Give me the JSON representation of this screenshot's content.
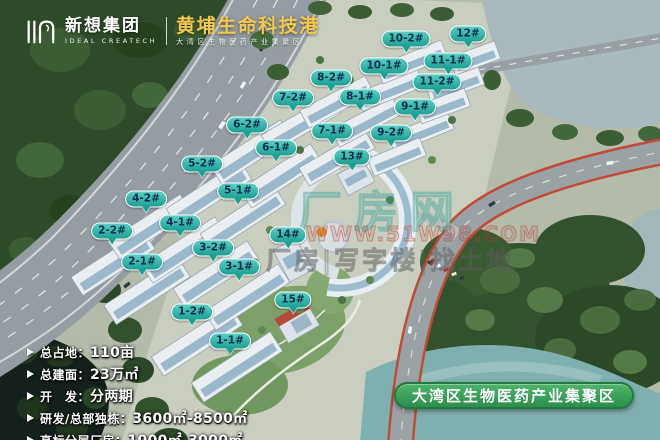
{
  "header": {
    "company_cn": "新想集团",
    "company_en": "IDEAL CREATECH",
    "title": "黄埔生命科技港",
    "subtitle": "大湾区生物医药产业集聚区"
  },
  "building_labels": [
    {
      "text": "1-1#",
      "x": 230,
      "y": 341
    },
    {
      "text": "1-2#",
      "x": 192,
      "y": 312
    },
    {
      "text": "2-1#",
      "x": 142,
      "y": 262
    },
    {
      "text": "2-2#",
      "x": 112,
      "y": 231
    },
    {
      "text": "3-1#",
      "x": 239,
      "y": 267
    },
    {
      "text": "3-2#",
      "x": 213,
      "y": 248
    },
    {
      "text": "4-1#",
      "x": 180,
      "y": 223
    },
    {
      "text": "4-2#",
      "x": 146,
      "y": 199
    },
    {
      "text": "5-1#",
      "x": 238,
      "y": 191
    },
    {
      "text": "5-2#",
      "x": 202,
      "y": 164
    },
    {
      "text": "6-1#",
      "x": 276,
      "y": 148
    },
    {
      "text": "6-2#",
      "x": 247,
      "y": 125
    },
    {
      "text": "7-1#",
      "x": 332,
      "y": 131
    },
    {
      "text": "7-2#",
      "x": 293,
      "y": 98
    },
    {
      "text": "8-1#",
      "x": 360,
      "y": 97
    },
    {
      "text": "8-2#",
      "x": 331,
      "y": 78
    },
    {
      "text": "9-1#",
      "x": 415,
      "y": 107
    },
    {
      "text": "9-2#",
      "x": 391,
      "y": 133
    },
    {
      "text": "10-1#",
      "x": 384,
      "y": 66
    },
    {
      "text": "10-2#",
      "x": 406,
      "y": 39
    },
    {
      "text": "11-1#",
      "x": 448,
      "y": 61
    },
    {
      "text": "11-2#",
      "x": 437,
      "y": 82
    },
    {
      "text": "12#",
      "x": 468,
      "y": 34
    },
    {
      "text": "13#",
      "x": 352,
      "y": 157
    },
    {
      "text": "14#",
      "x": 288,
      "y": 235
    },
    {
      "text": "15#",
      "x": 293,
      "y": 300
    }
  ],
  "stats": [
    {
      "label": "总占地：",
      "value": "110亩"
    },
    {
      "label": "总建面：",
      "value": "23万㎡"
    },
    {
      "label": "开　发：",
      "value": "分两期"
    },
    {
      "label": "研发/总部独栋：",
      "value": "3600㎡-8500㎡"
    },
    {
      "label": "高标分层厂房：",
      "value": "1000㎡-3000㎡"
    }
  ],
  "banner": {
    "text": "大湾区生物医药产业集聚区"
  },
  "watermarks": {
    "site_name": "厂房网",
    "url": "WWW.51W98.COM",
    "slogan": "厂房|写字楼|找土地"
  },
  "colors": {
    "label_fill": "#1da093",
    "label_text": "#0a2e4e",
    "title_gold": "#f2c94c",
    "banner_green": "#2e8d4c",
    "highway_gray": "#959da2",
    "river_teal": "#7fb0b0"
  }
}
